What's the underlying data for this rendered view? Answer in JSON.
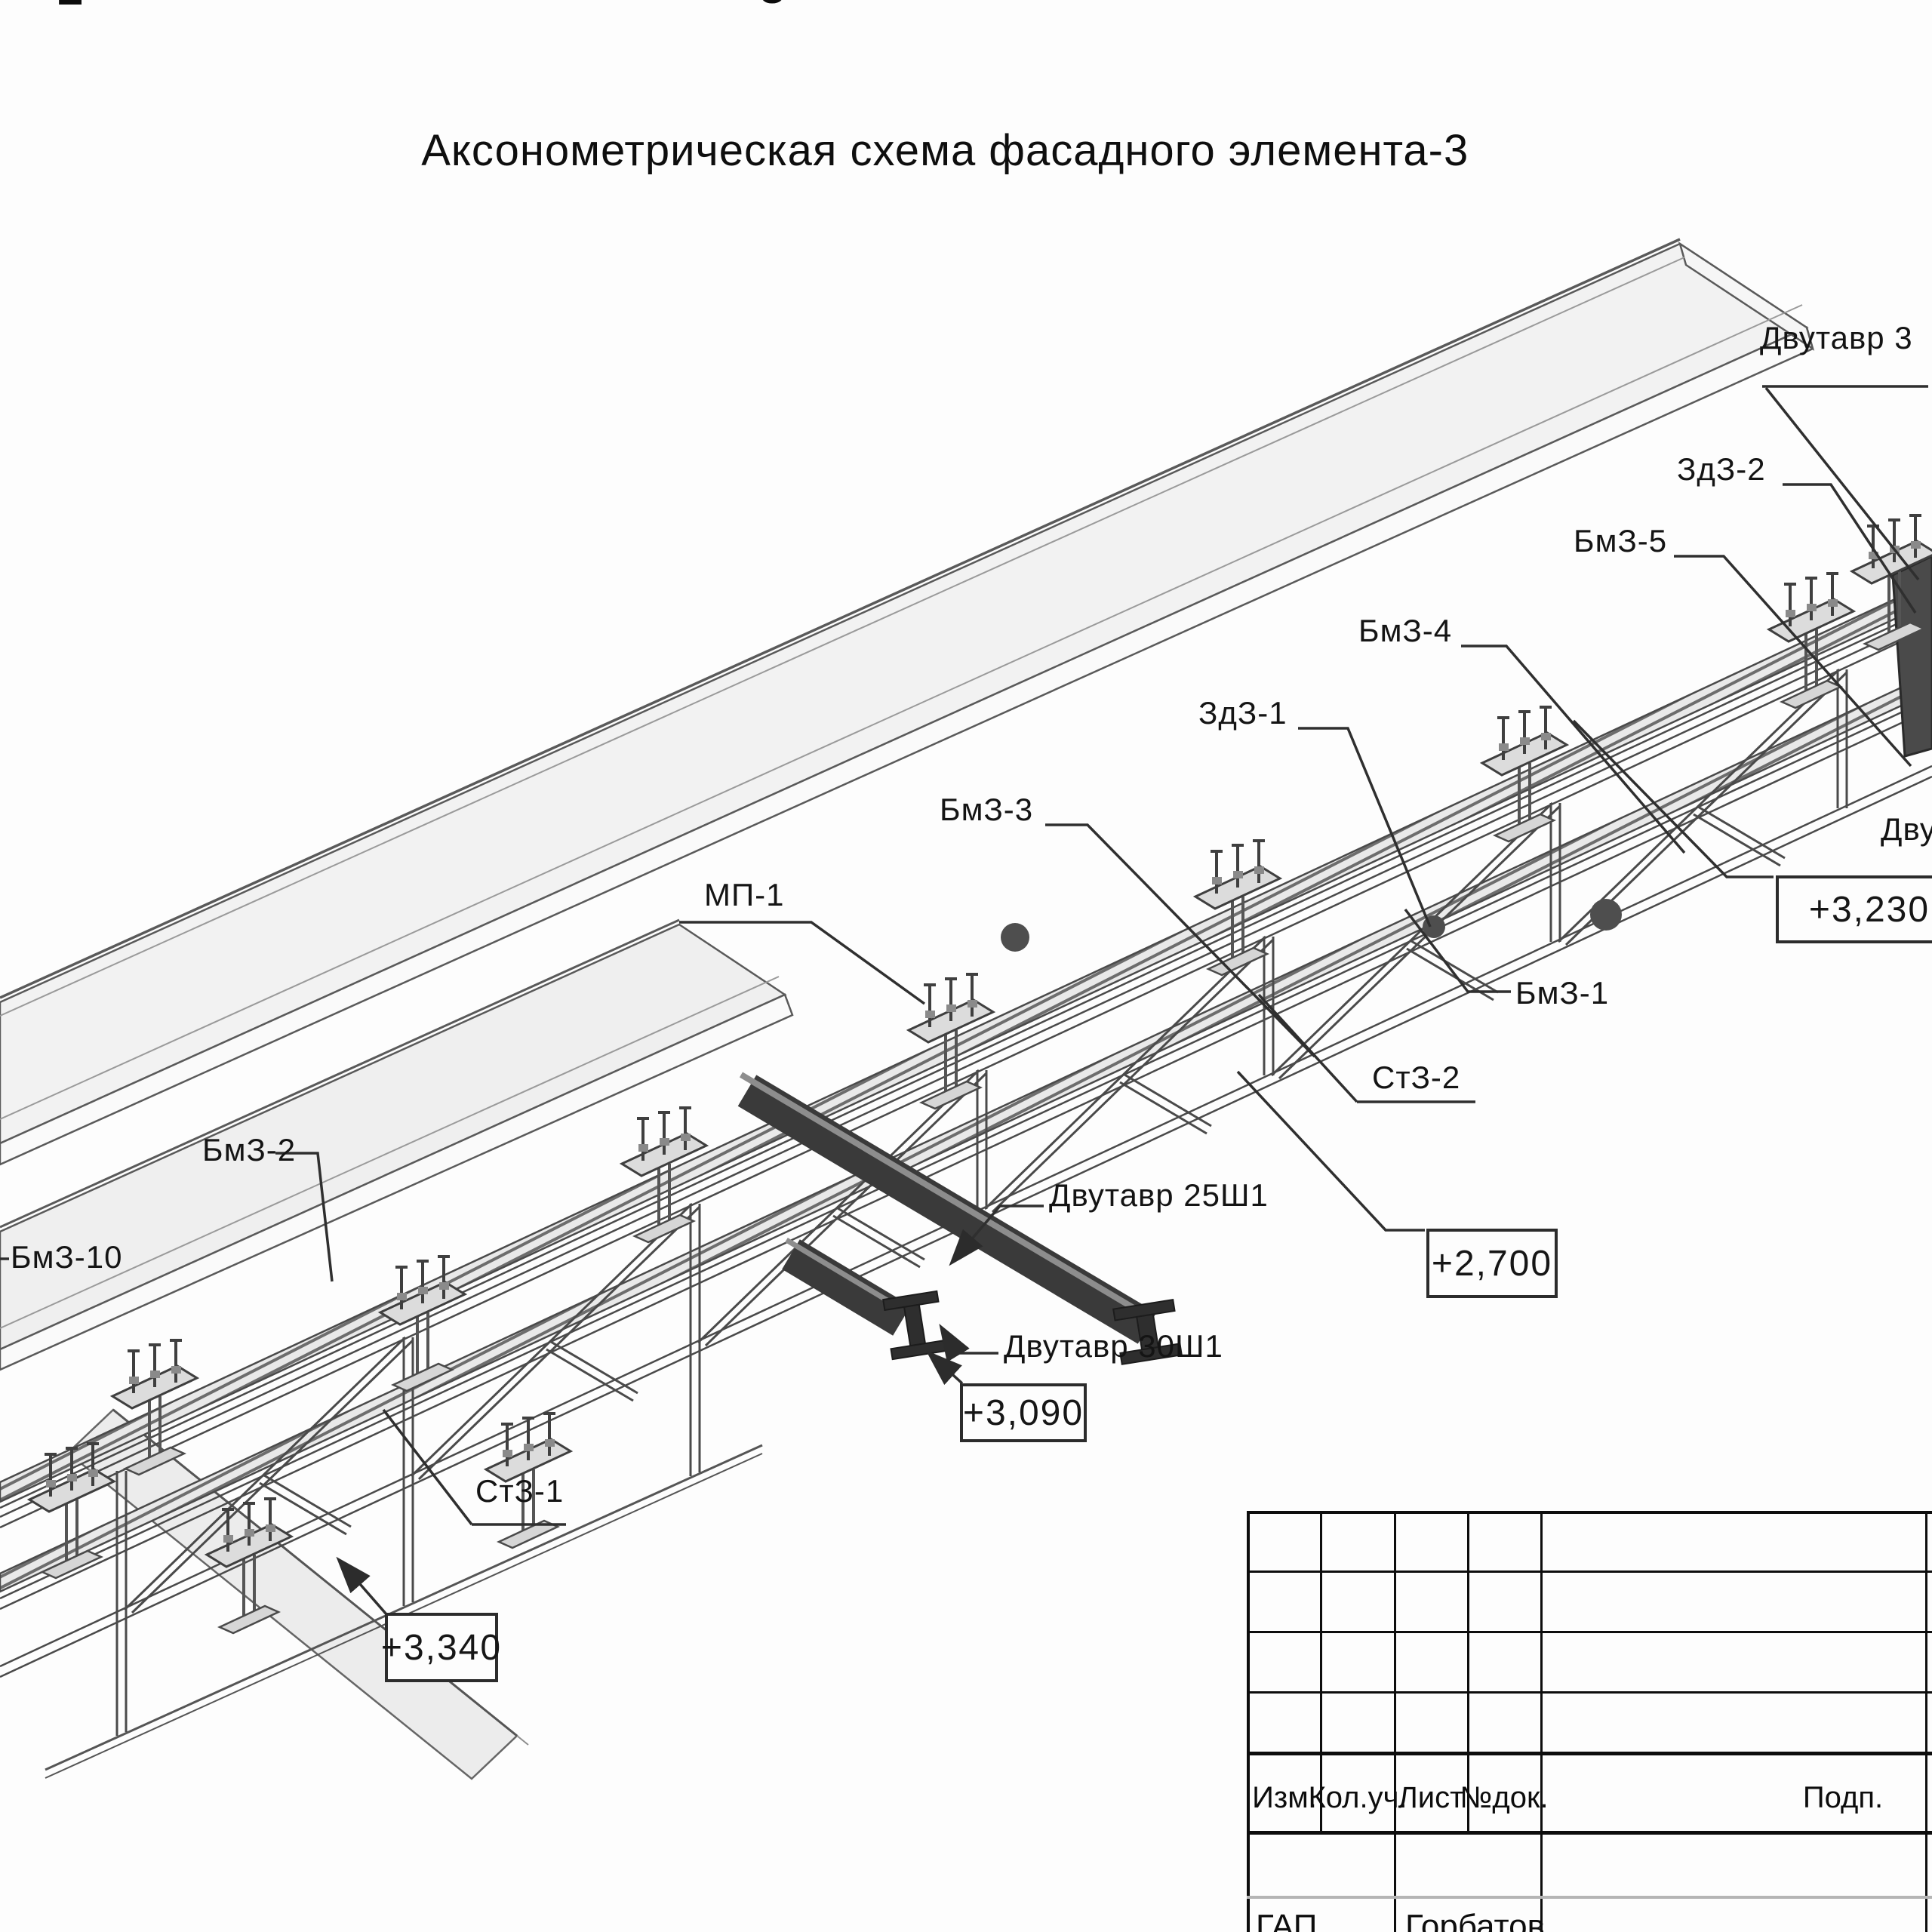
{
  "page": {
    "background": "#fdfdfd",
    "line_color": "#3d3d3d",
    "panel_fill": "#f2f2f2",
    "dark_beam_color": "#383838",
    "title": "Аксонометрическая схема фасадного элемента-3"
  },
  "partials": {
    "top_left": "2",
    "top_middle": "3",
    "right_beam": "Двутавр 3",
    "right_dvu": "Дву"
  },
  "labels": {
    "zd3_2": "ЗдЗ-2",
    "bm3_5": "БмЗ-5",
    "bm3_4": "БмЗ-4",
    "zd3_1": "ЗдЗ-1",
    "bm3_3": "БмЗ-3",
    "mp_1": "МП-1",
    "bm3_1": "БмЗ-1",
    "st3_2": "СтЗ-2",
    "beam_25sh1": "Двутавр 25Ш1",
    "beam_30sh1": "Двутавр 30Ш1",
    "bm3_2": "БмЗ-2",
    "bm3_10": "БмЗ-10",
    "st3_1": "СтЗ-1"
  },
  "elevations": {
    "right": "+3,230",
    "middle": "+2,700",
    "lower": "+3,090",
    "left": "+3,340"
  },
  "titleblock": {
    "headers": [
      "Изм.",
      "Кол.уч.",
      "Лист",
      "№док.",
      "Подп."
    ],
    "signature_row": {
      "role": "ГАП",
      "name": "Горбатов"
    }
  }
}
